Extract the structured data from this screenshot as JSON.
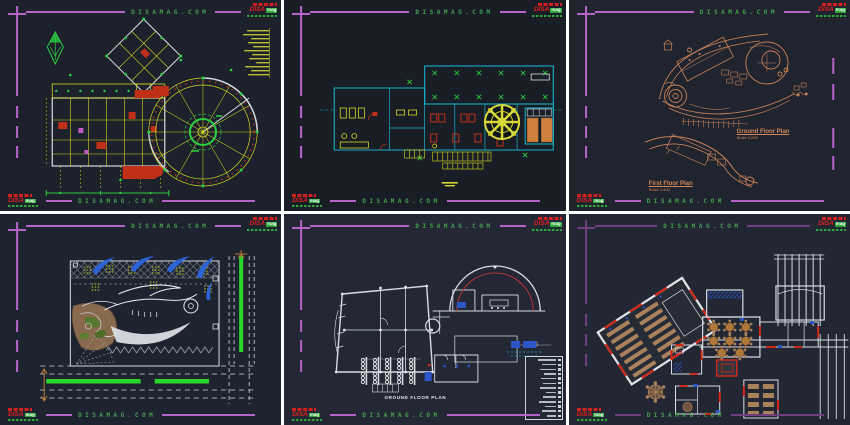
{
  "watermark": {
    "text": "DISAMAG.COM"
  },
  "logo": {
    "brand": "DISA",
    "suffix": "mag"
  },
  "panels": {
    "p3": {
      "ground_title": "Ground Floor Plan",
      "ground_scale": "Scale 1/200",
      "first_title": "First Floor Plan",
      "first_scale": "Scale 1/100"
    },
    "p5": {
      "plan_label": "GROUND FLOOR PLAN",
      "legend_rows": 13
    }
  },
  "colors": {
    "frame_magenta": "#b465c8",
    "frame_dim_purple": "#6f3f80",
    "watermark_green": "#46a24e",
    "logo_red": "#e02020",
    "logo_green": "#2da63a",
    "cad_yellow": "#d6d622",
    "cad_cyan": "#18b0c8",
    "cad_orange": "#c8825a",
    "cad_bright_green": "#2bd62b",
    "cad_blue": "#2e63d6",
    "panel_background": "#1e2330"
  }
}
